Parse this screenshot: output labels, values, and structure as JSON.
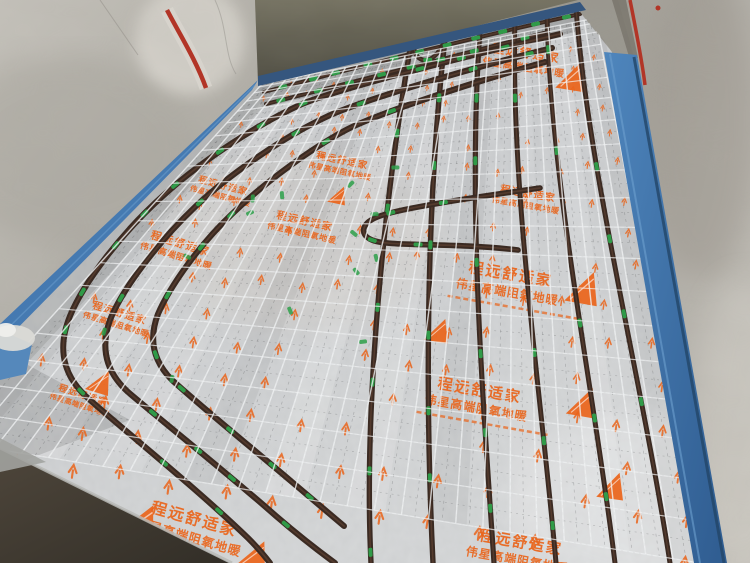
{
  "scene": {
    "description": "Construction photo: hydronic underfloor heating loops of dark PEX pipe fixed on silver insulation foil, covered by a white steel wire mesh, with blue edge insulation strips along bare concrete walls."
  },
  "foil_print": {
    "brand_line": "程远舒适家",
    "product_line": "伟星高端阻氧地暖"
  },
  "colors": {
    "foil_silver": "#c6c8ca",
    "pipe_brown": "#3a2a22",
    "mesh_white": "#f0f2f3",
    "clip_green": "#2ea04a",
    "print_orange": "#ea641a",
    "edge_strip_blue": "#4a80b8",
    "wall_concrete": "#b5b2ab",
    "back_wall_shadow": "#5e5b4e",
    "bare_floor": "#453e34",
    "conduit_red": "#b23527"
  }
}
